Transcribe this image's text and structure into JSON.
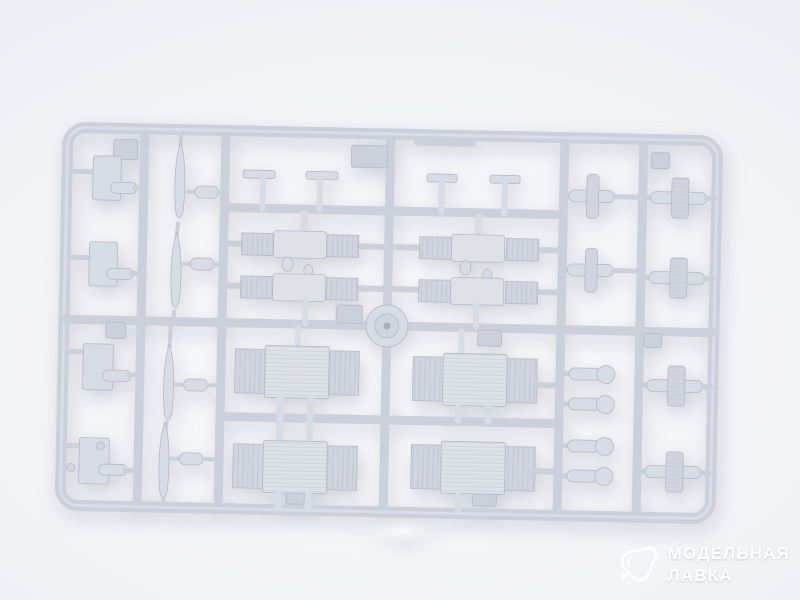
{
  "scene": {
    "subject": "Light grey injection-molded plastic model kit sprue with parts on a white studio background",
    "background_light": "#fafbfd",
    "background_mid": "#f2f3f7",
    "background_dark": "#e7e9ef",
    "plastic_color": "#ccd0da",
    "part_color": "#d8dce4",
    "panel_color": "#d2d5df",
    "block_color": "#dee1e8",
    "edge_color": "#b6bac7"
  },
  "watermark": {
    "icon": "gem-logo",
    "line1": "МОДЕЛЬНАЯ",
    "line2": "ЛАВКА",
    "text_color": "#ffffff"
  }
}
